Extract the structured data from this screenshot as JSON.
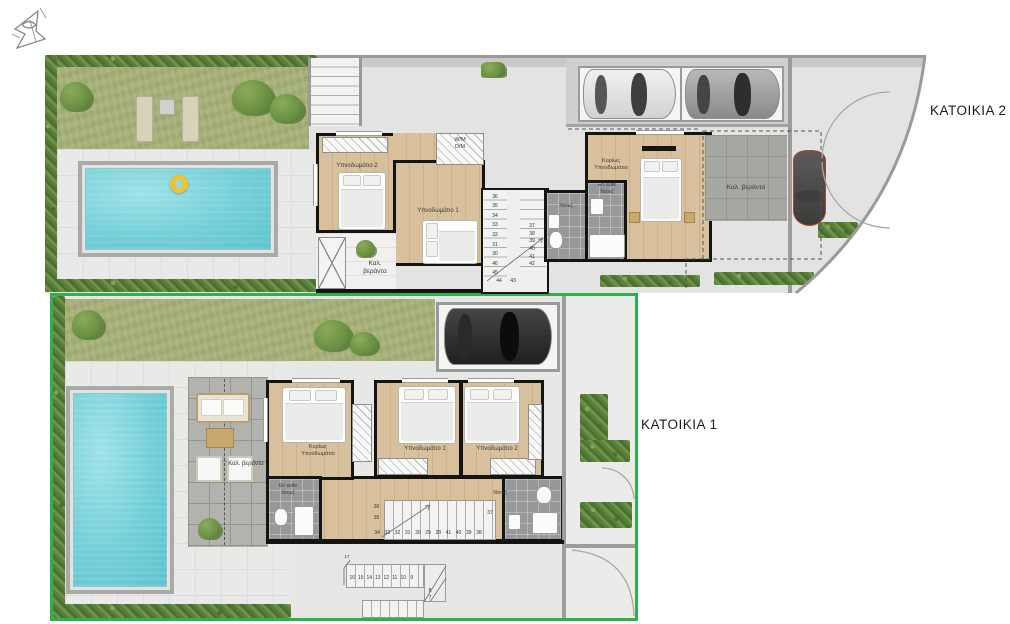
{
  "labels": {
    "residence2": "ΚΑΤΟΙΚΙΑ 2",
    "residence1": "ΚΑΤΟΙΚΙΑ 1"
  },
  "plan2": {
    "bedroom2": "Υπνοδωμάτιο 2",
    "bedroom1": "Υπνοδωμάτιο 1",
    "master_line1": "Κυρίως",
    "master_line2": "Υπνοδωμάτιο",
    "wm_line1": "W/M",
    "wm_line2": "D/M",
    "shower": "Ντουζ",
    "ensuite_line1": "En suite",
    "ensuite_line2": "Ντουζ",
    "veranda_line1": "Καλ.",
    "veranda_line2": "βεράντα",
    "veranda_right": "Καλ. βεράντα",
    "stairs_left": [
      "36",
      "35",
      "34",
      "33",
      "32",
      "31",
      "30",
      "46",
      "45"
    ],
    "stairs_right": [
      "37",
      "38",
      "39",
      "40",
      "41",
      "42"
    ],
    "stairs_bottom": [
      "44",
      "43"
    ]
  },
  "plan1": {
    "master_line1": "Κυρίως",
    "master_line2": "Υπνοδωμάτιο",
    "bedroom1": "Υπνοδωμάτιο 1",
    "bedroom2": "Υπνοδωμάτιο 2",
    "ensuite_line1": "En suite",
    "ensuite_line2": "Ντουζ",
    "shower": "Ντουζ",
    "veranda": "Καλ. βεράντα",
    "stairs_left": [
      "36",
      "35"
    ],
    "stairs_run": [
      "34",
      "33",
      "32",
      "31",
      "30",
      "29",
      "28",
      "41",
      "40",
      "39",
      "38"
    ],
    "stairs_right": "37",
    "ext_top": "17",
    "ext_run": [
      "16",
      "15",
      "14",
      "13",
      "12",
      "11",
      "10",
      "9"
    ],
    "ext_side": [
      "8",
      "7"
    ]
  },
  "colors": {
    "plot_outline_green": "#2eb14d",
    "pool_water": "#74cfd8",
    "lawn_green": "#a6b078",
    "hedge_green": "#5f8a41",
    "wall_black": "#141414",
    "wood_floor": "#d8c09c",
    "float_ring_yellow": "#f1c22f"
  }
}
